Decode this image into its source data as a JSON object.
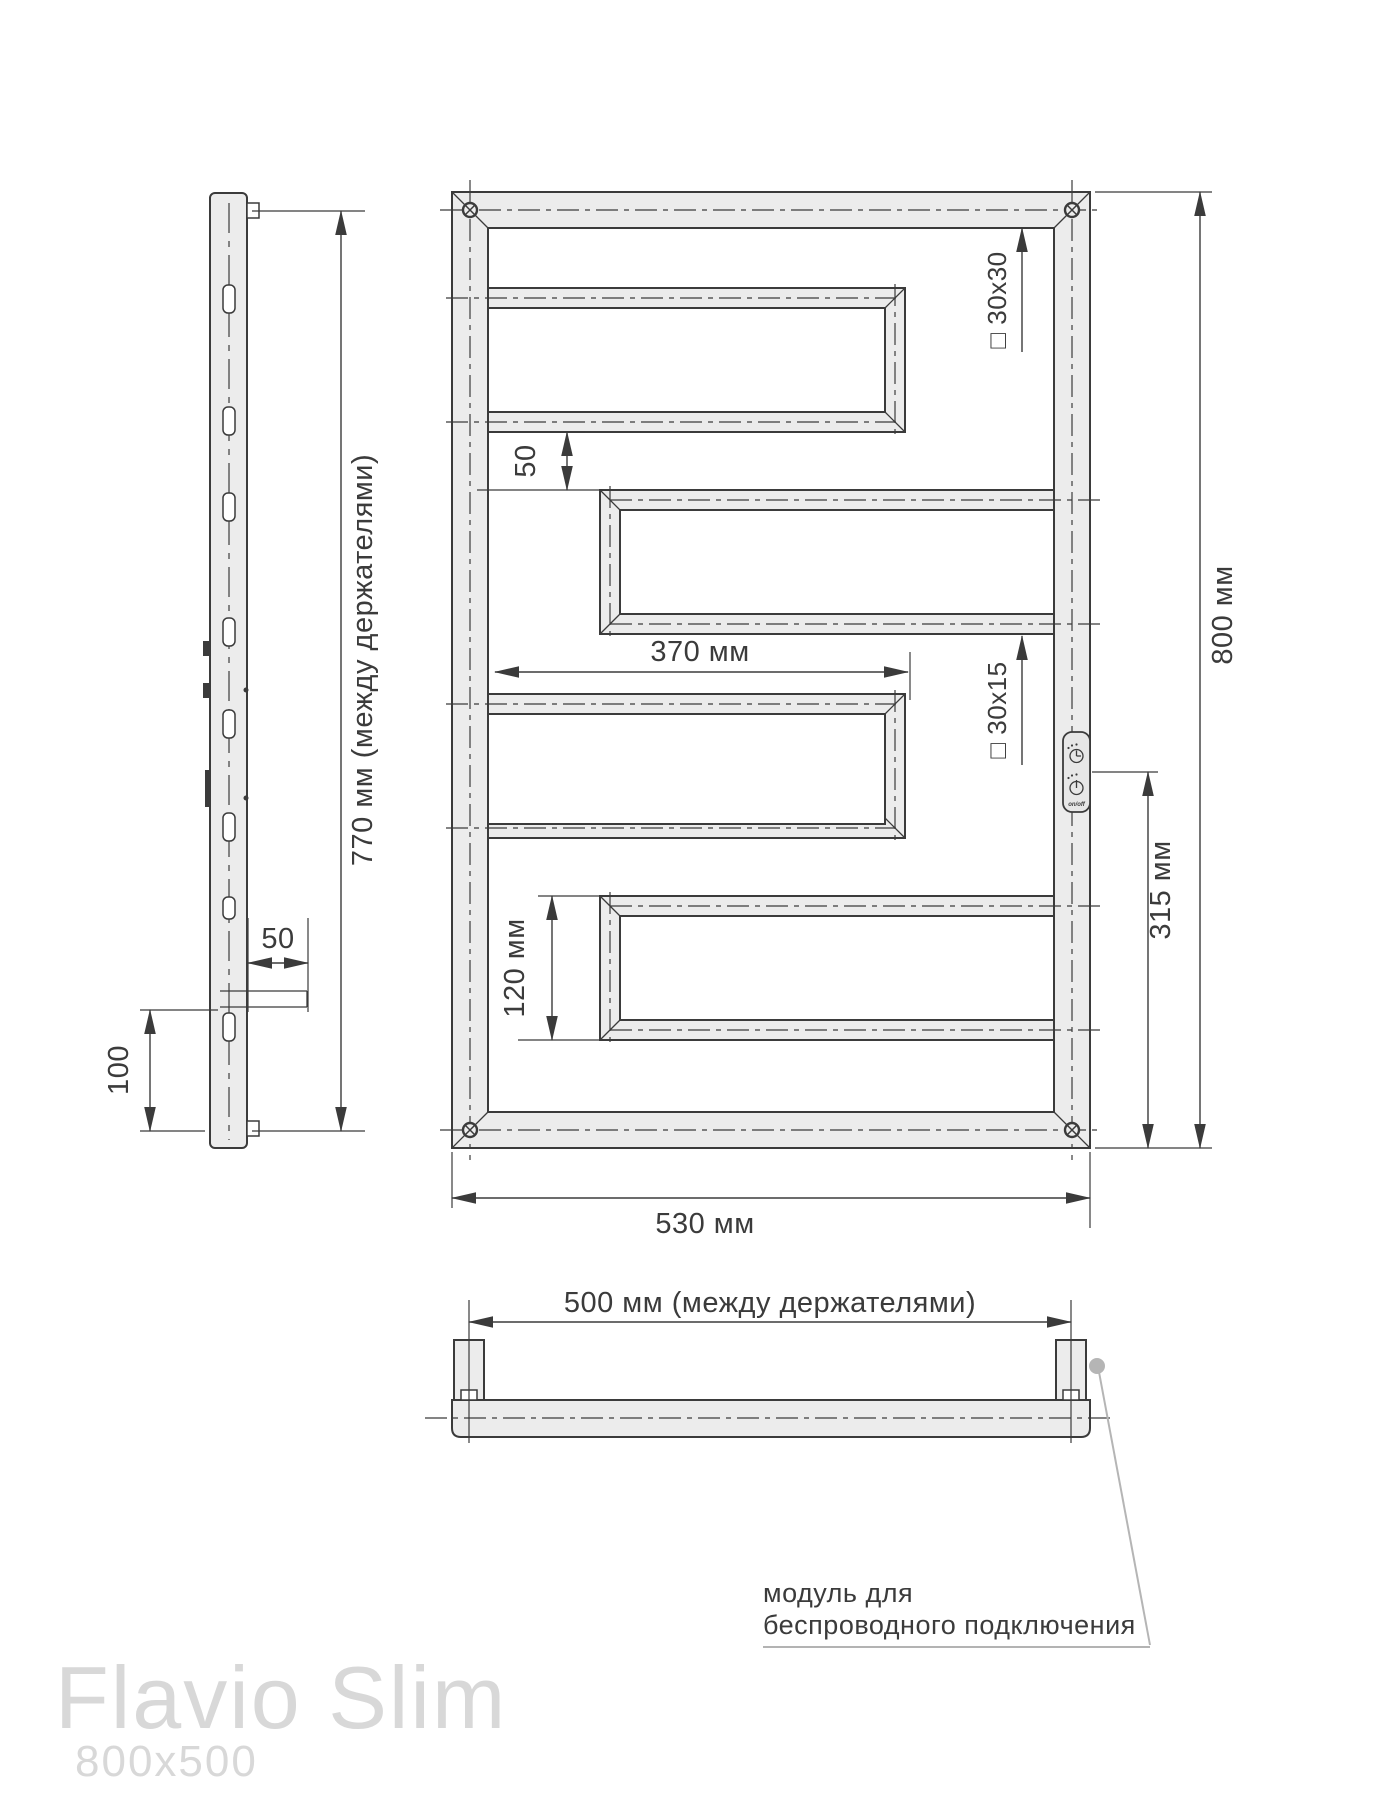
{
  "title": {
    "name": "Flavio Slim",
    "size": "800x500"
  },
  "side_view": {
    "height_between_holders_label": "770 мм (между держателями)",
    "bracket_depth_label": "50",
    "bottom_offset_label": "100"
  },
  "front_view": {
    "gap_label": "50",
    "bar_length_label": "370 мм",
    "frame_profile_label": "□ 30x30",
    "bar_profile_label": "□ 30x15",
    "total_height_label": "800 мм",
    "module_height_label": "315 мм",
    "bar_height_label": "120 мм",
    "total_width_label": "530 мм",
    "module_onoff_label": "on/off"
  },
  "bottom_view": {
    "width_between_holders_label": "500 мм (между держателями)"
  },
  "callout": {
    "line1": "модуль для",
    "line2": "беспроводного подключения"
  },
  "colors": {
    "line": "#3b3b3b",
    "tube_fill": "#ececec",
    "leader_gray": "#b5b5b5",
    "title_gray": "#d8d8d8"
  }
}
